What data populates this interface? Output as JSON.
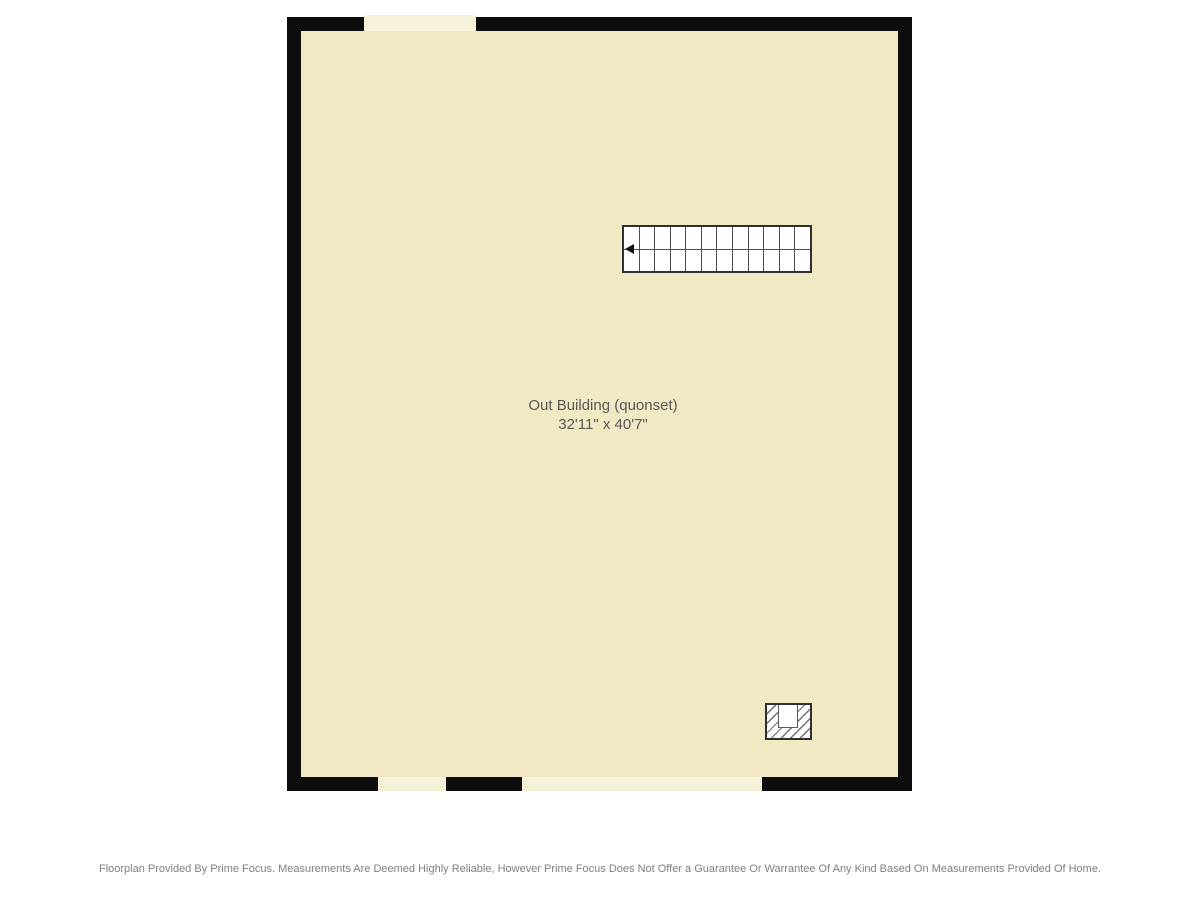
{
  "floorplan": {
    "room": {
      "label": "Out Building (quonset)",
      "dimensions": "32'11\" x 40'7\""
    },
    "stairs": {
      "step_count": 12,
      "direction": "left"
    },
    "openings": {
      "top_wall": 1,
      "bottom_wall": 2
    },
    "colors": {
      "wall": "#0d0d0d",
      "room_fill": "#f0e9c3",
      "opening_fill": "#f6f1d9",
      "stair_line": "#4f4f4f",
      "label_text": "#58585a",
      "disclaimer_text": "#7f7f7f",
      "background": "#ffffff"
    }
  },
  "footer": {
    "disclaimer": "Floorplan Provided By Prime Focus. Measurements Are Deemed Highly Reliable, However Prime Focus Does Not Offer a Guarantee Or Warrantee Of Any Kind Based On Measurements Provided Of Home."
  }
}
